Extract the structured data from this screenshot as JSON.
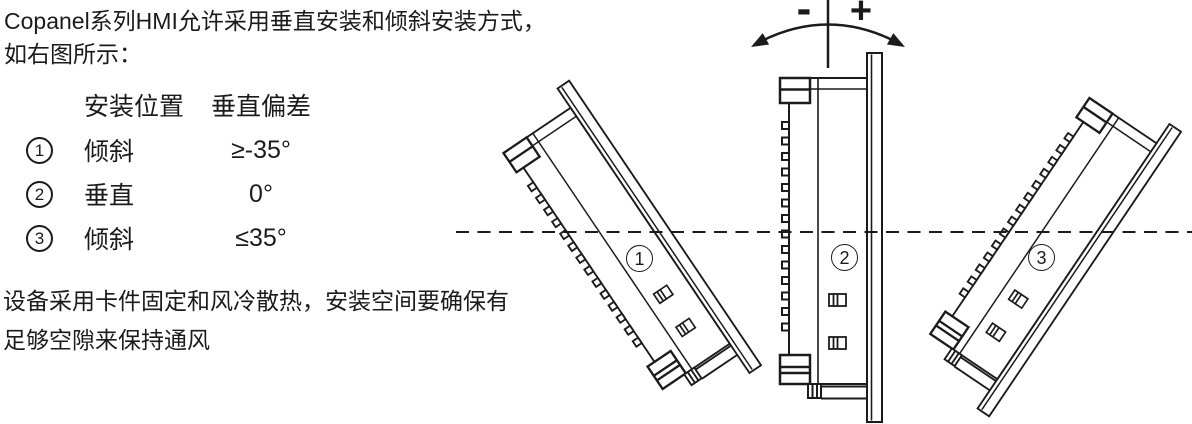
{
  "intro": {
    "line1": "Copanel系列HMI允许采用垂直安装和倾斜安装方式，",
    "line2": "如右图所示："
  },
  "mount_table": {
    "headers": {
      "position": "安装位置",
      "deviation": "垂直偏差"
    },
    "rows": [
      {
        "num": "1",
        "position": "倾斜",
        "deviation": "≥-35°"
      },
      {
        "num": "2",
        "position": "垂直",
        "deviation": "0°"
      },
      {
        "num": "3",
        "position": "倾斜",
        "deviation": "≤35°"
      }
    ]
  },
  "note": {
    "line1": "设备采用卡件固定和风冷散热，安装空间要确保有",
    "line2": "足够空隙来保持通风"
  },
  "diagram": {
    "minus_label": "-",
    "plus_label": "+",
    "panel_labels": [
      "1",
      "2",
      "3"
    ],
    "line_color": "#1b1b1b"
  }
}
